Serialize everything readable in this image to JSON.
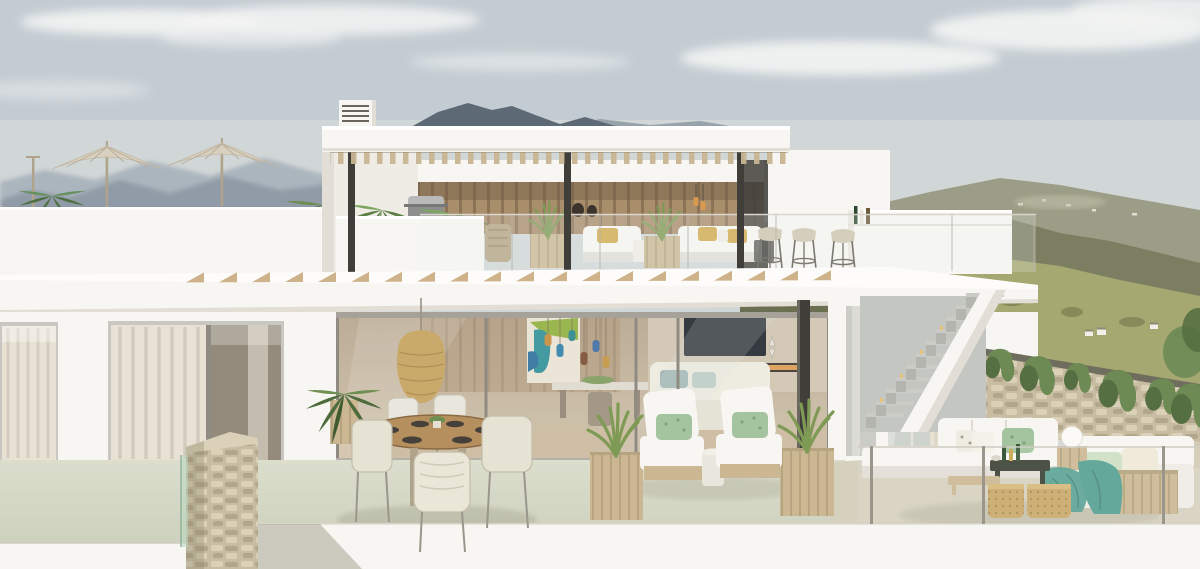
{
  "scene": {
    "type": "architectural_exterior_render",
    "description": "Day-time render of a two-storey modern white villa: roof deck with two parasols, upper pergola terrace with outdoor kitchen, bar stools and white lounge sofas behind glass balustrades, lower terrace with round dining set, rattan pendant lamp, sun loungers and planters, right-hand garden terrace with corner sofa beside a dry-stone ivy wall and an external staircase, hazy mountain ranges behind",
    "time_of_day": "day",
    "visible_text": ""
  },
  "palette": {
    "sky_top": "#c3ccd3",
    "sky_bottom": "#d7dad8",
    "cloud": "#f4f5f3",
    "mtn_far": "#a7b1ba",
    "mtn_mid": "#8b98a4",
    "peak_dark": "#5d6a75",
    "peak_mid": "#8a95a0",
    "olive_far": "#9c9d86",
    "olive_mid": "#7b7e60",
    "olive_near": "#6b6f52",
    "olive_hi": "#93946f",
    "grass_hill": "#a6a871",
    "grass_dark": "#7c7e53",
    "white_hi": "#f8f6f2",
    "white_mid": "#efece6",
    "white_shadow": "#e2ded6",
    "wood_slat": "#c9b592",
    "wood_wall": "#a98e6c",
    "wood_wall_dark": "#8d7355",
    "col_dark": "#403e39",
    "floor_sage": "#d9dcc9",
    "floor_sage_dark": "#c9cdb8",
    "floor_beige": "#d2cbb6",
    "stone_base": "#c8bda2",
    "stone_hi": "#dad1b8",
    "stone_dark": "#b2a78c",
    "wall_cap": "#6f6e5e",
    "ivy": "#6d8a54",
    "ivy_dark": "#566f42",
    "wicker": "#c9aa6b",
    "wicker_dark": "#a9894f",
    "wood_light": "#cbb893",
    "pillow_yellow": "#d2a94c",
    "pillow_green": "#a3c49f",
    "teal": "#57a193",
    "umbrella": "#d9d0c0",
    "pole": "#b0a38b",
    "palm": "#52703f",
    "palm_light": "#6f8f52",
    "grass_plant": "#7f9a55",
    "interior_warm": "#b7a68c",
    "interior_dark": "#8a7a60",
    "tv_dark": "#1e242a",
    "fire_glow": "#d89a4e",
    "art_green": "#8fae3a",
    "art_teal": "#2e8f96",
    "art_blue": "#2c6f9a",
    "stool_seat": "#cfc5ae",
    "curtain": "#e9e2d4",
    "curtain_dim": "#cfc8ba",
    "pane_dark": "#948b7d",
    "step_gray": "#cbccc6",
    "step_dark": "#b4b5ae"
  },
  "objects": {
    "roof_deck": {
      "parasols": 2,
      "lamp_post": 1,
      "palm_clusters": 2
    },
    "upper_terrace": {
      "pergola_columns": 3,
      "bar_stools": 3,
      "sofas": 2,
      "grass_planters": 2,
      "palm_planters": 2,
      "bbq_grill": 1,
      "pendant_lights": 2,
      "vases": 2,
      "bar_counter": 1
    },
    "lower_terrace": {
      "dining_table": 1,
      "dining_chairs": 5,
      "pendant_lamp": 1,
      "potted_palm": 1,
      "sun_loungers": 2,
      "drum_side_table": 1,
      "grass_planters": 2,
      "structural_column": 1
    },
    "right_terrace": {
      "sofa_sections": 2,
      "poufs": 2,
      "coffee_table": 1,
      "bench": 1,
      "ball_lamp": 1,
      "wood_cube_table": 1,
      "throw_blanket": 1,
      "glass_balustrade_posts": 3
    },
    "landscape": {
      "stone_wall": true,
      "ivy_clumps": 7,
      "staircase": true,
      "distant_houses": 3,
      "stone_pillar": 1
    }
  },
  "decor": {
    "rafter_shadows": {
      "count": 20,
      "start_x": 186,
      "step": 33,
      "base_y": 283,
      "w": 18,
      "h": 10
    },
    "stairs": {
      "count": 11,
      "x0": 866,
      "y0": 416,
      "dx": 10,
      "dy": 12,
      "riser_w": 10,
      "riser_h": 12
    }
  }
}
